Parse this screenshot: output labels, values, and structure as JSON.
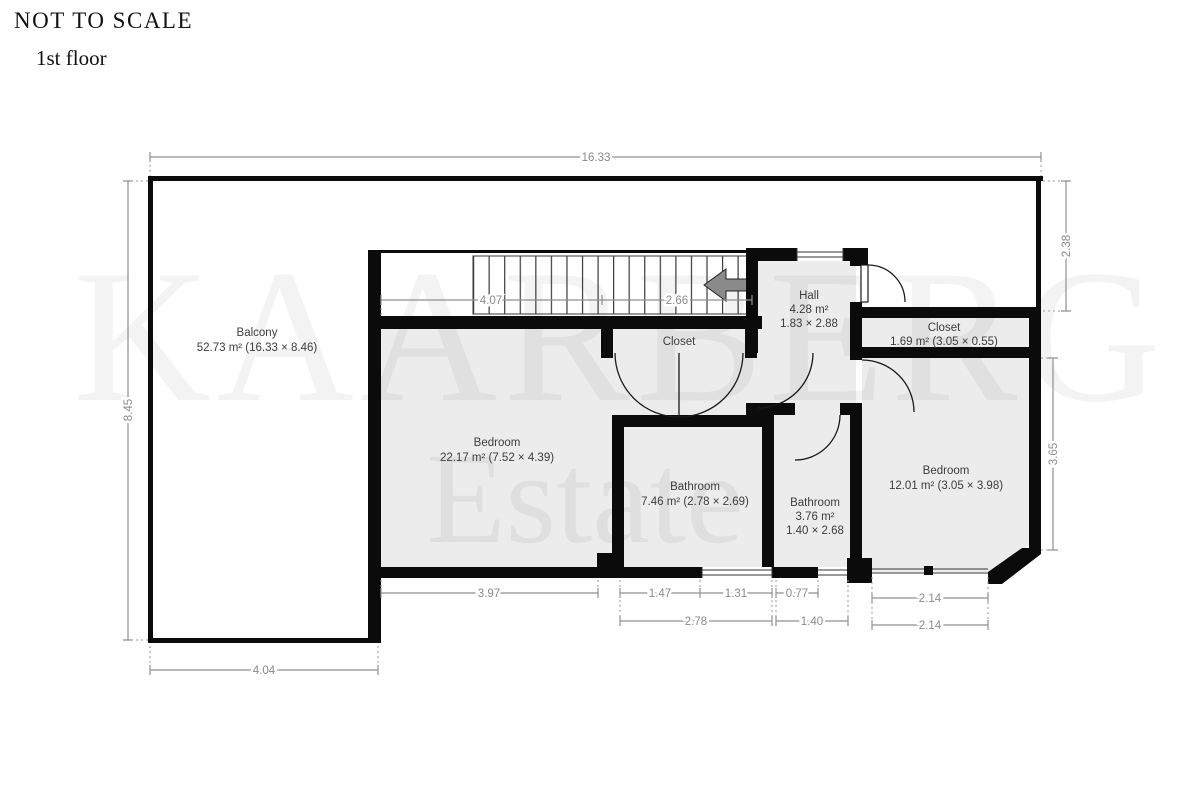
{
  "page": {
    "title": "NOT TO SCALE",
    "subtitle": "1st floor"
  },
  "watermark": {
    "line1": "KAARBERG",
    "line2": "Estate"
  },
  "rooms": {
    "balcony": {
      "name": "Balcony",
      "area": "52.73 m² (16.33 × 8.46)"
    },
    "bedroom_large": {
      "name": "Bedroom",
      "area": "22.17 m² (7.52 × 4.39)"
    },
    "bathroom_large": {
      "name": "Bathroom",
      "area": "7.46 m² (2.78 × 2.69)"
    },
    "bathroom_small": {
      "name": "Bathroom",
      "area": "3.76 m²",
      "dims": "1.40 × 2.68"
    },
    "bedroom_small": {
      "name": "Bedroom",
      "area": "12.01 m² (3.05 × 3.98)"
    },
    "hall": {
      "name": "Hall",
      "area": "4.28 m²",
      "dims": "1.83 × 2.88"
    },
    "closet_center": {
      "name": "Closet"
    },
    "closet_right": {
      "name": "Closet",
      "area": "1.69 m² (3.05 × 0.55)"
    }
  },
  "dimensions": {
    "overall_width": "16.33",
    "overall_height": "8.45",
    "right_upper": "2.38",
    "right_lower": "3.65",
    "balcony_bottom": "4.04",
    "stair_left": "4.07",
    "stair_right": "2.66",
    "bottom_row1": {
      "d1": "3.97",
      "d2": "1.47",
      "d3": "1.31",
      "d4": "0.77",
      "d5": "2.14"
    },
    "bottom_row2": {
      "d1": "2.78",
      "d2": "1.40",
      "d3": "2.14"
    }
  },
  "colors": {
    "wall": "#0b0b0b",
    "room_fill": "#ececec",
    "dimension": "#8a8a8a"
  }
}
